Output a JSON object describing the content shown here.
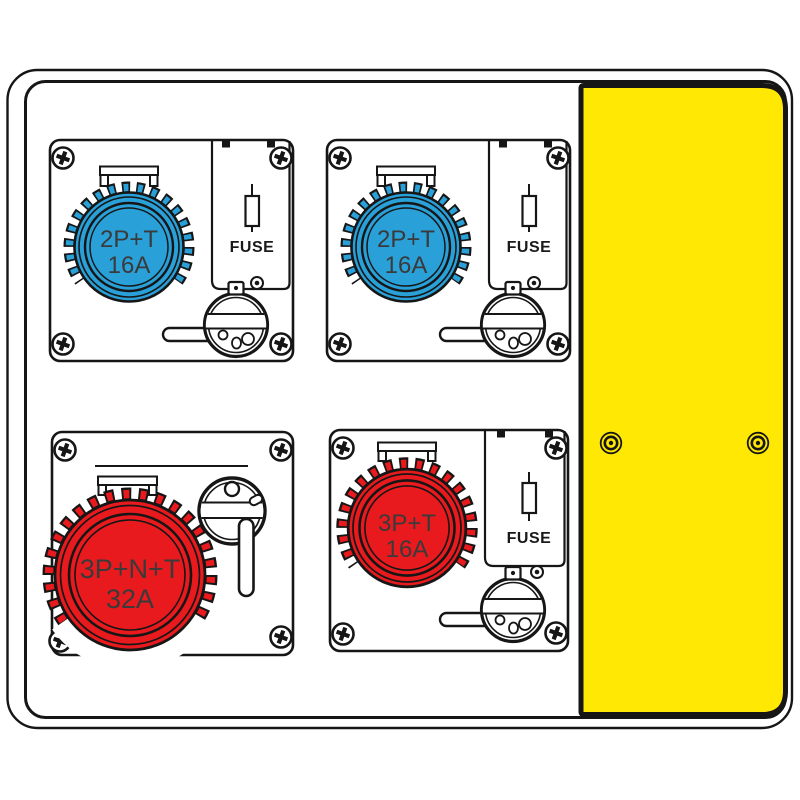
{
  "board": {
    "line_color": "#161616",
    "background": "#ffffff",
    "cover_panel": {
      "color": "#FFE803"
    },
    "modules": [
      {
        "position": "top-left",
        "socket_color": "#29A0D8",
        "label_line1": "2P+T",
        "label_line2": "16A",
        "fuse_label": "FUSE"
      },
      {
        "position": "top-right",
        "socket_color": "#29A0D8",
        "label_line1": "2P+T",
        "label_line2": "16A",
        "fuse_label": "FUSE"
      },
      {
        "position": "bottom-left",
        "socket_color": "#E81A1E",
        "label_line1": "3P+N+T",
        "label_line2": "32A"
      },
      {
        "position": "bottom-right",
        "socket_color": "#E81A1E",
        "label_line1": "3P+T",
        "label_line2": "16A",
        "fuse_label": "FUSE"
      }
    ]
  }
}
